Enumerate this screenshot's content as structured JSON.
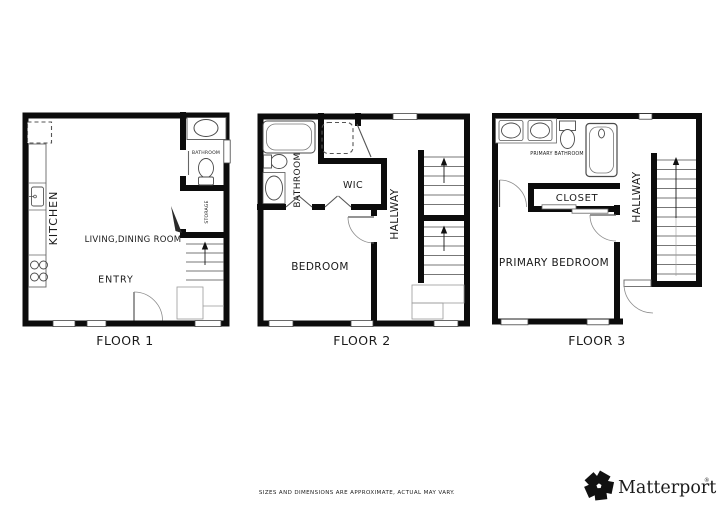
{
  "floors": [
    {
      "label": "FLOOR 1",
      "rooms": {
        "kitchen": "KITCHEN",
        "living_dining": "LIVING,DINING ROOM",
        "entry": "ENTRY",
        "bathroom": "BATHROOM",
        "storage": "STORAGE"
      },
      "fixtures": [
        "refrigerator",
        "kitchen-counter",
        "kitchen-sink",
        "stove",
        "vanity-sink",
        "toilet",
        "stairs-up",
        "entry-door"
      ]
    },
    {
      "label": "FLOOR 2",
      "rooms": {
        "bathroom": "BATHROOM",
        "wic": "WIC",
        "hallway": "HALLWAY",
        "bedroom": "BEDROOM"
      },
      "fixtures": [
        "bathtub",
        "toilet",
        "vanity-sink",
        "washer",
        "stairs-up-lower",
        "stairs-up-upper",
        "bedroom-door"
      ]
    },
    {
      "label": "FLOOR 3",
      "rooms": {
        "primary_bathroom": "PRIMARY BATHROOM",
        "closet": "CLOSET",
        "hallway": "HALLWAY",
        "primary_bedroom": "PRIMARY BEDROOM"
      },
      "fixtures": [
        "double-vanity-sinks",
        "toilet",
        "shower",
        "sliding-closet-door",
        "stairs-up",
        "bedroom-door"
      ]
    }
  ],
  "footer": {
    "disclaimer": "SIZES AND DIMENSIONS ARE APPROXIMATE, ACTUAL MAY VARY."
  },
  "brand": {
    "name": "Matterport",
    "registered_mark": "®"
  },
  "colors": {
    "background": "#ffffff",
    "wall": "#0c0c0c",
    "fixture_line": "#4a4a4a",
    "thin_line": "#8c8c8c",
    "label": "#1a1a1a",
    "disclaimer": "#9a9a9a",
    "brand": "#1a1a1a"
  }
}
